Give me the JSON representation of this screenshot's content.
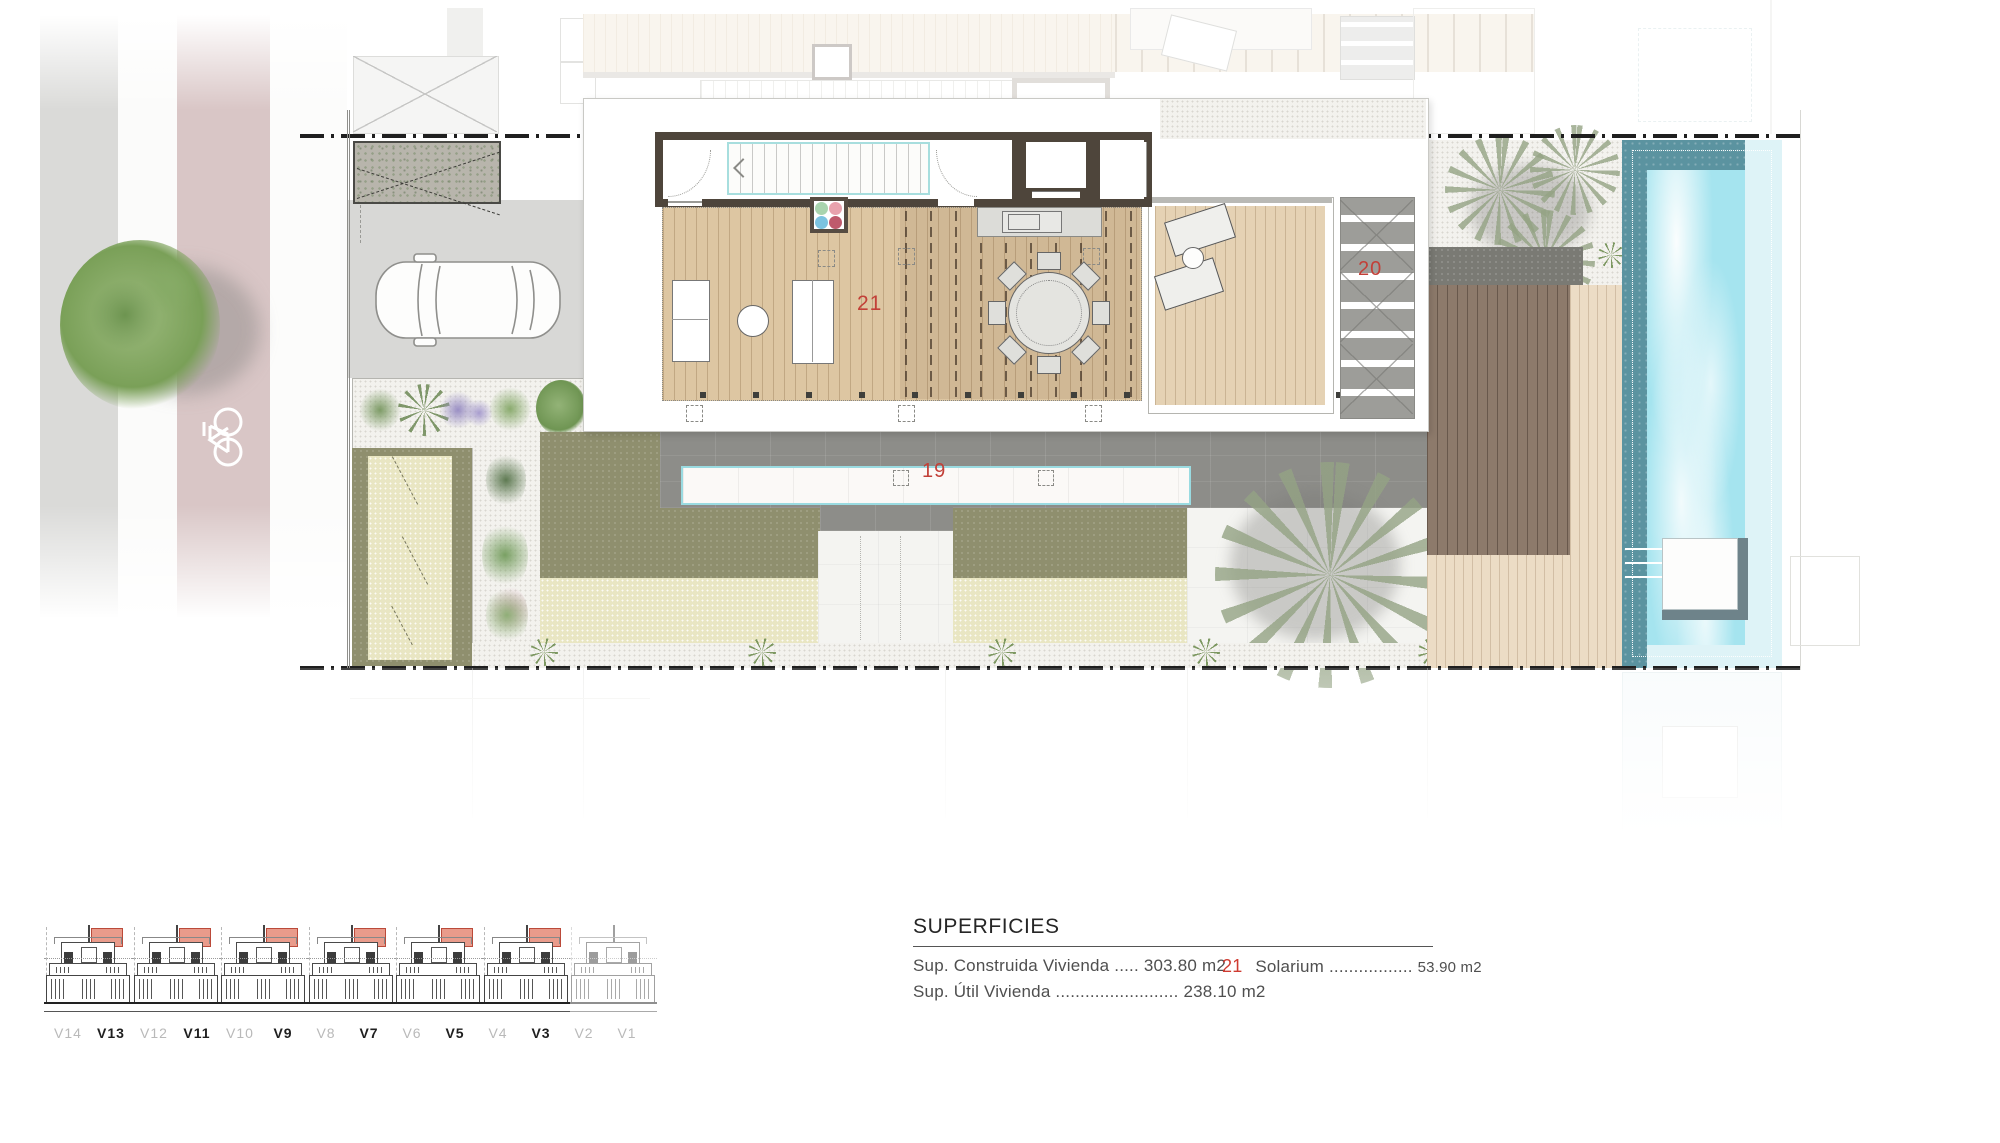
{
  "plan": {
    "area_labels": [
      {
        "id": "21",
        "text": "21",
        "meaning": "solarium"
      },
      {
        "id": "20",
        "text": "20",
        "meaning": "louvered-stair"
      },
      {
        "id": "19",
        "text": "19",
        "meaning": "lap-pool"
      }
    ],
    "accent_red": "#c24038",
    "pool_color": "#a5e4ef",
    "wood_color": "#ddc6a2"
  },
  "legend": {
    "title": "SUPERFICIES",
    "rows": [
      {
        "label": "Sup. Construida Vivienda",
        "dots": ".....",
        "value": "303.80 m2"
      },
      {
        "label": "Sup. Útil Vivienda",
        "dots": ".........................",
        "value": "238.10 m2"
      }
    ],
    "highlight": {
      "num": "21",
      "label": "Solarium",
      "dots": ".................",
      "value": "53.90 m2"
    }
  },
  "villas": [
    {
      "label": "V14",
      "active": false
    },
    {
      "label": "V13",
      "active": true
    },
    {
      "label": "V12",
      "active": false
    },
    {
      "label": "V11",
      "active": true
    },
    {
      "label": "V10",
      "active": false
    },
    {
      "label": "V9",
      "active": true
    },
    {
      "label": "V8",
      "active": false
    },
    {
      "label": "V7",
      "active": true
    },
    {
      "label": "V6",
      "active": false
    },
    {
      "label": "V5",
      "active": true
    },
    {
      "label": "V4",
      "active": false
    },
    {
      "label": "V3",
      "active": true
    },
    {
      "label": "V2",
      "active": false
    },
    {
      "label": "V1",
      "active": false
    }
  ],
  "elevation": {
    "groups": [
      {
        "red": true
      },
      {
        "red": true
      },
      {
        "red": true
      },
      {
        "red": true
      },
      {
        "red": true
      },
      {
        "red": true
      },
      {
        "red": false
      }
    ]
  }
}
